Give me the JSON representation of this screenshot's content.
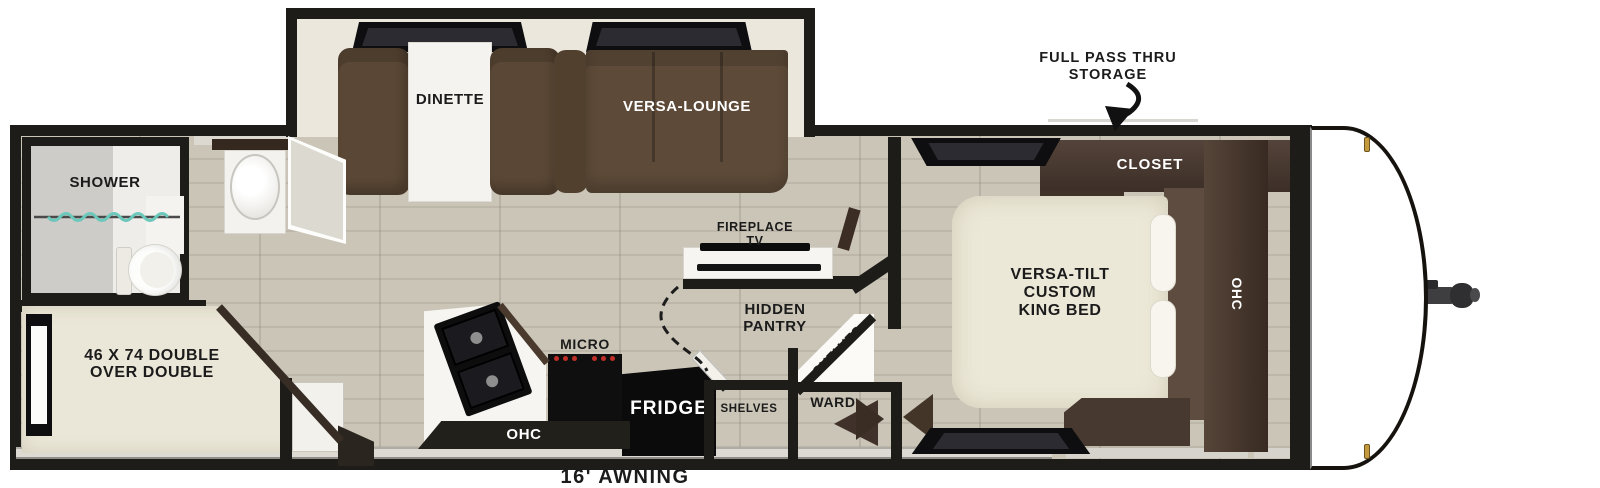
{
  "floorplan": {
    "awning": "16' AWNING",
    "storage": {
      "line1": "FULL PASS THRU",
      "line2": "STORAGE"
    },
    "bedroom": {
      "closet": "CLOSET",
      "ohc": "OHC",
      "bed": {
        "line1": "VERSA-TILT",
        "line2": "CUSTOM",
        "line3": "KING BED"
      }
    },
    "living": {
      "dinette": "DINETTE",
      "versa_lounge": "VERSA-LOUNGE",
      "fireplace": {
        "line1": "FIREPLACE",
        "line2": "TV"
      }
    },
    "kitchen": {
      "micro": "MICRO",
      "fridge": "FRIDGE",
      "ohc": "OHC",
      "pantry": {
        "line1": "HIDDEN",
        "line2": "PANTRY"
      },
      "shelves_corner": "SHELVES",
      "shelves_closet": "SHELVES",
      "wardrobe": "WARD"
    },
    "rear": {
      "shower": "SHOWER",
      "bunk": {
        "line1": "46 X 74 DOUBLE",
        "line2": "OVER DOUBLE"
      }
    },
    "colors": {
      "wall": "#1e1c19",
      "floor": "#cac5b7",
      "furniture_cream": "#ece8d9",
      "sofa_brown": "#5d4a38",
      "cabinet_wood": "#463931",
      "shower_curtain_teal": "#6cc8bb",
      "burner_red": "#c03028",
      "clearance_light_gold": "#c59a3d"
    }
  }
}
